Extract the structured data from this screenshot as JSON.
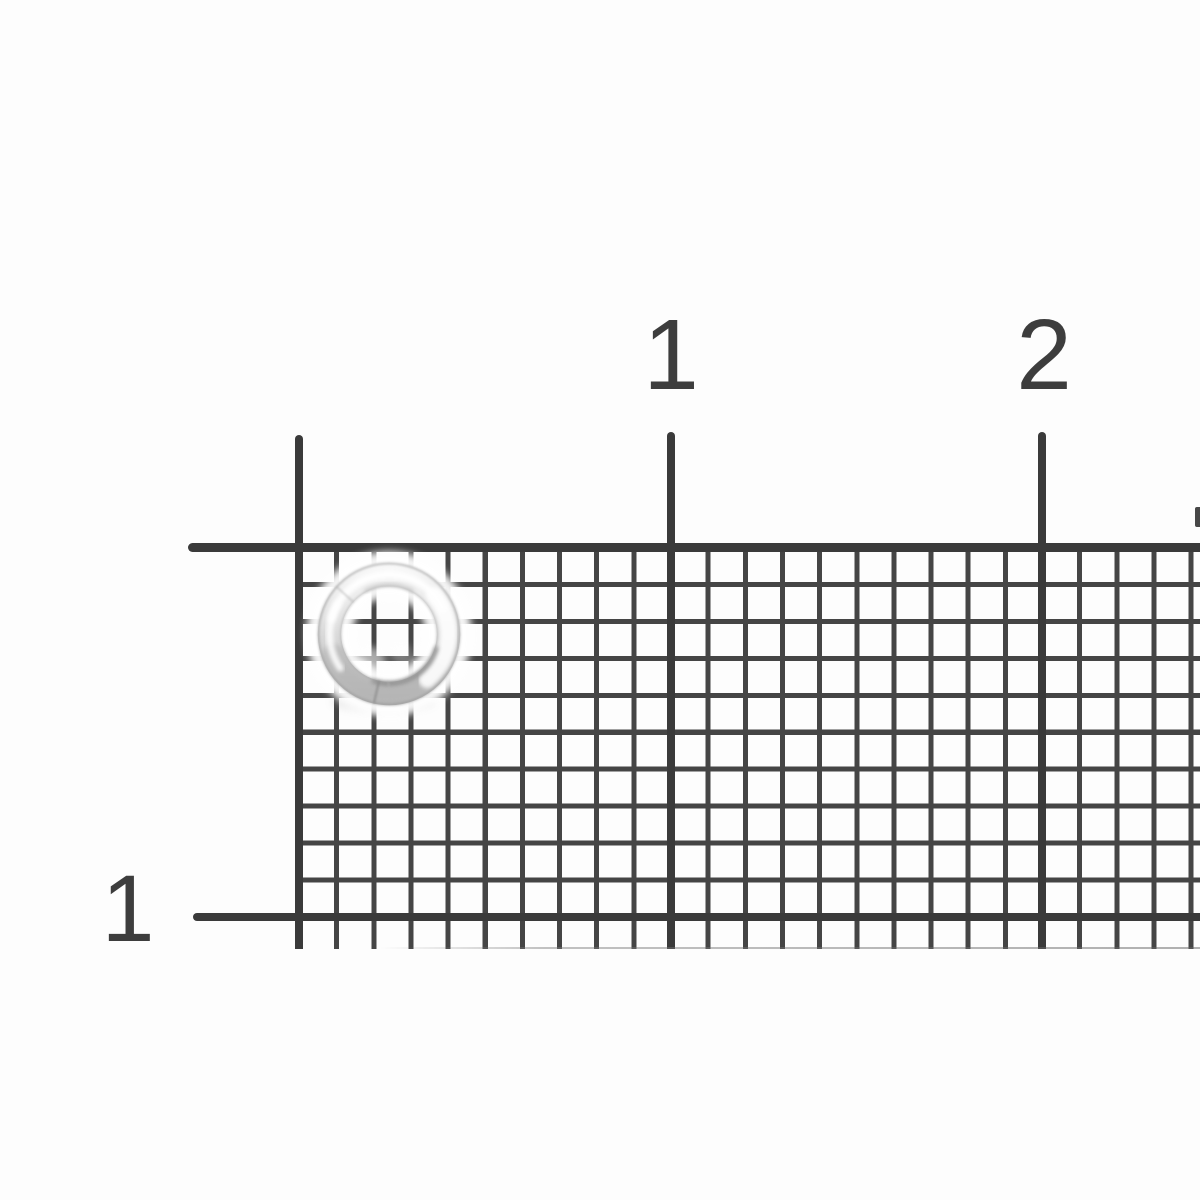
{
  "photo": {
    "subject": "silver split ring lying on black millimeter grid paper",
    "background_color": "#fdfdfd",
    "grid_line_color": "#454545",
    "grid_major_line_color": "#3a3a3a",
    "ring_base_color": "#d9d9d9",
    "ring_highlight_color": "#ffffff",
    "ring_shadow_color": "#8a8a8a"
  },
  "ruler": {
    "top_labels": [
      {
        "text": "1"
      },
      {
        "text": "2"
      }
    ],
    "left_label": {
      "text": "1"
    }
  }
}
